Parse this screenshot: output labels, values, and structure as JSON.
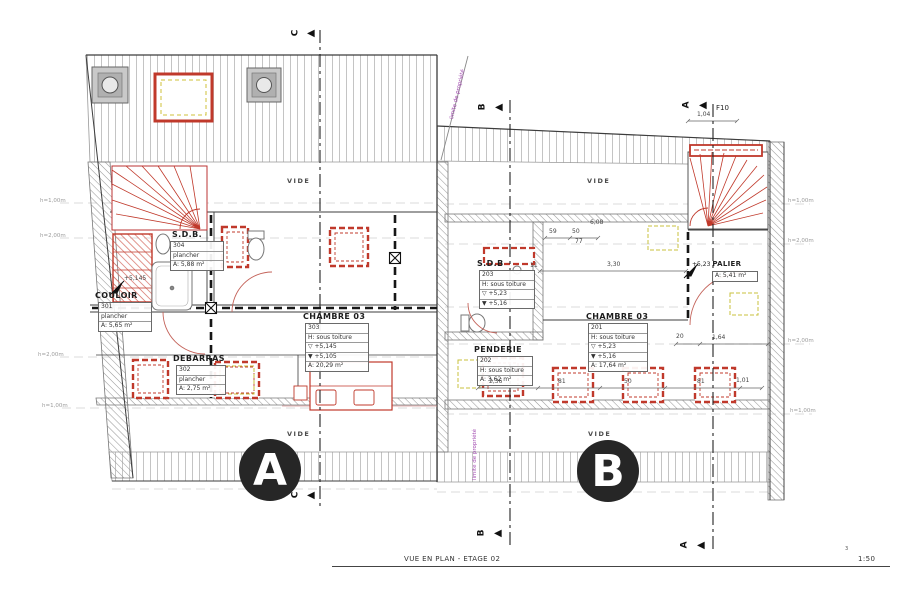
{
  "title_block": {
    "title": "VUE EN PLAN - ETAGE 02",
    "scale": "1:50",
    "sheet_no": "3"
  },
  "property_label": "limite de propriété",
  "vide_label": "VIDE",
  "markers": {
    "a": "A",
    "b": "B",
    "c": "C",
    "f10": "F10",
    "dim_104": "1,04"
  },
  "bubbles": {
    "a": "A",
    "b": "B"
  },
  "height_labels": {
    "h100": "h=1,00m",
    "h200": "h=2,00m"
  },
  "levels": {
    "etage_left": "+5,145",
    "palier_level": "+5,23"
  },
  "rooms": {
    "couloir": {
      "name": "COULOIR",
      "number": "301",
      "floor": "plancher",
      "area": "A: 5,65 m²"
    },
    "debarras": {
      "name": "DEBARRAS",
      "number": "302",
      "floor": "plancher",
      "area": "A: 2,75 m²"
    },
    "chambre_303": {
      "name": "CHAMBRE 03",
      "number": "303",
      "height": "H: sous toiture",
      "level_top": "▽ +5,145",
      "level_bottom": "▼ +5,105",
      "area": "A: 20,29 m²"
    },
    "sdb_304": {
      "name": "S.D.B.",
      "number": "304",
      "floor": "plancher",
      "area": "A: 5,88 m²"
    },
    "sdb_203": {
      "name": "S.D.B",
      "number": "203",
      "height": "H: sous toiture",
      "level_top": "▽ +5,23",
      "level_bottom": "▼ +5,16"
    },
    "chambre_201": {
      "name": "CHAMBRE 03",
      "number": "201",
      "height": "H: sous toiture",
      "level_top": "▽ +5,23",
      "level_bottom": "▼ +5,16",
      "area": "A: 17,64 m²"
    },
    "penderie": {
      "name": "PENDERIE",
      "number": "202",
      "height": "H: sous toiture",
      "area": "A: 3,62 m²"
    },
    "palier": {
      "name": "PALIER",
      "level": "+5,23",
      "area": "A: 5,41 m²"
    }
  },
  "dimensions": {
    "d59": "59",
    "d50": "50",
    "d77": "77",
    "d608": "6,08",
    "d330": "3,30",
    "d11": "11",
    "d20": "20",
    "d164": "1,64",
    "d236": "2,36",
    "d81a": "81",
    "d50b": "50",
    "d81b": "81",
    "d101": "1,01"
  },
  "colors": {
    "red": "#c0392b",
    "purple": "#a24bb0",
    "wall": "#444444",
    "hatch": "#b5b5b5",
    "dim": "#555555"
  }
}
